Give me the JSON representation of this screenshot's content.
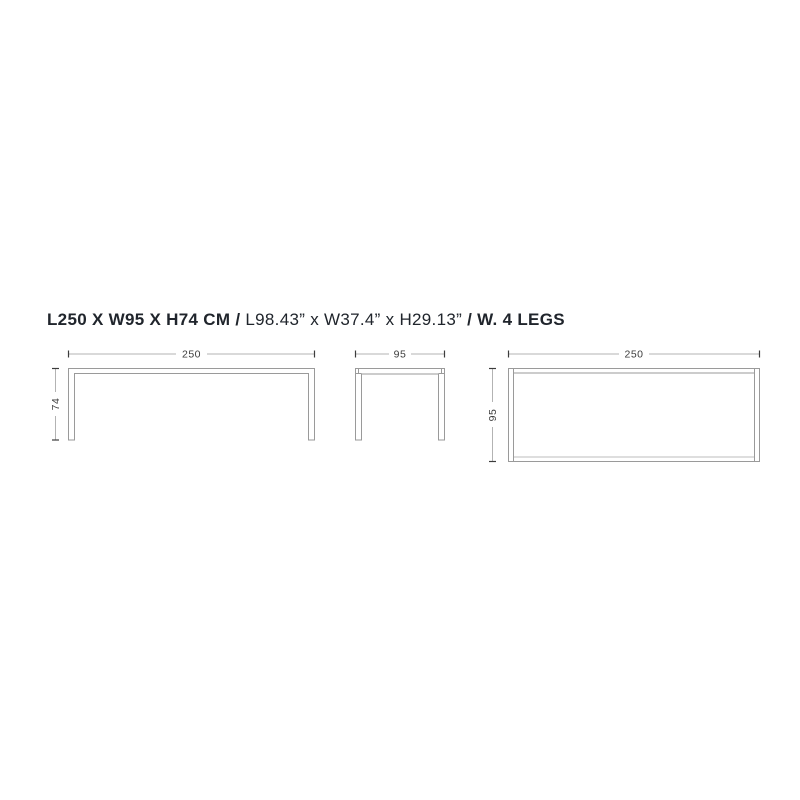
{
  "title": {
    "metric": "L250 X W95 X H74 CM",
    "separator": "/",
    "imperial": "L98.43” x W37.4” x H29.13”",
    "legs": "W. 4 LEGS"
  },
  "views": {
    "front_elevation": {
      "name": "front elevation",
      "width_cm": "250",
      "height_cm": "74"
    },
    "side_elevation": {
      "name": "side elevation",
      "depth_cm": "95"
    },
    "top_plan": {
      "name": "top plan",
      "length_cm": "250",
      "depth_cm": "95"
    }
  },
  "colors": {
    "outline": "#9a9a9a",
    "dimension_line": "#b3b3b3",
    "tick": "#3c3c3c",
    "dimension_text": "#3c3c3c",
    "title_text": "#20252c",
    "background": "#ffffff"
  }
}
